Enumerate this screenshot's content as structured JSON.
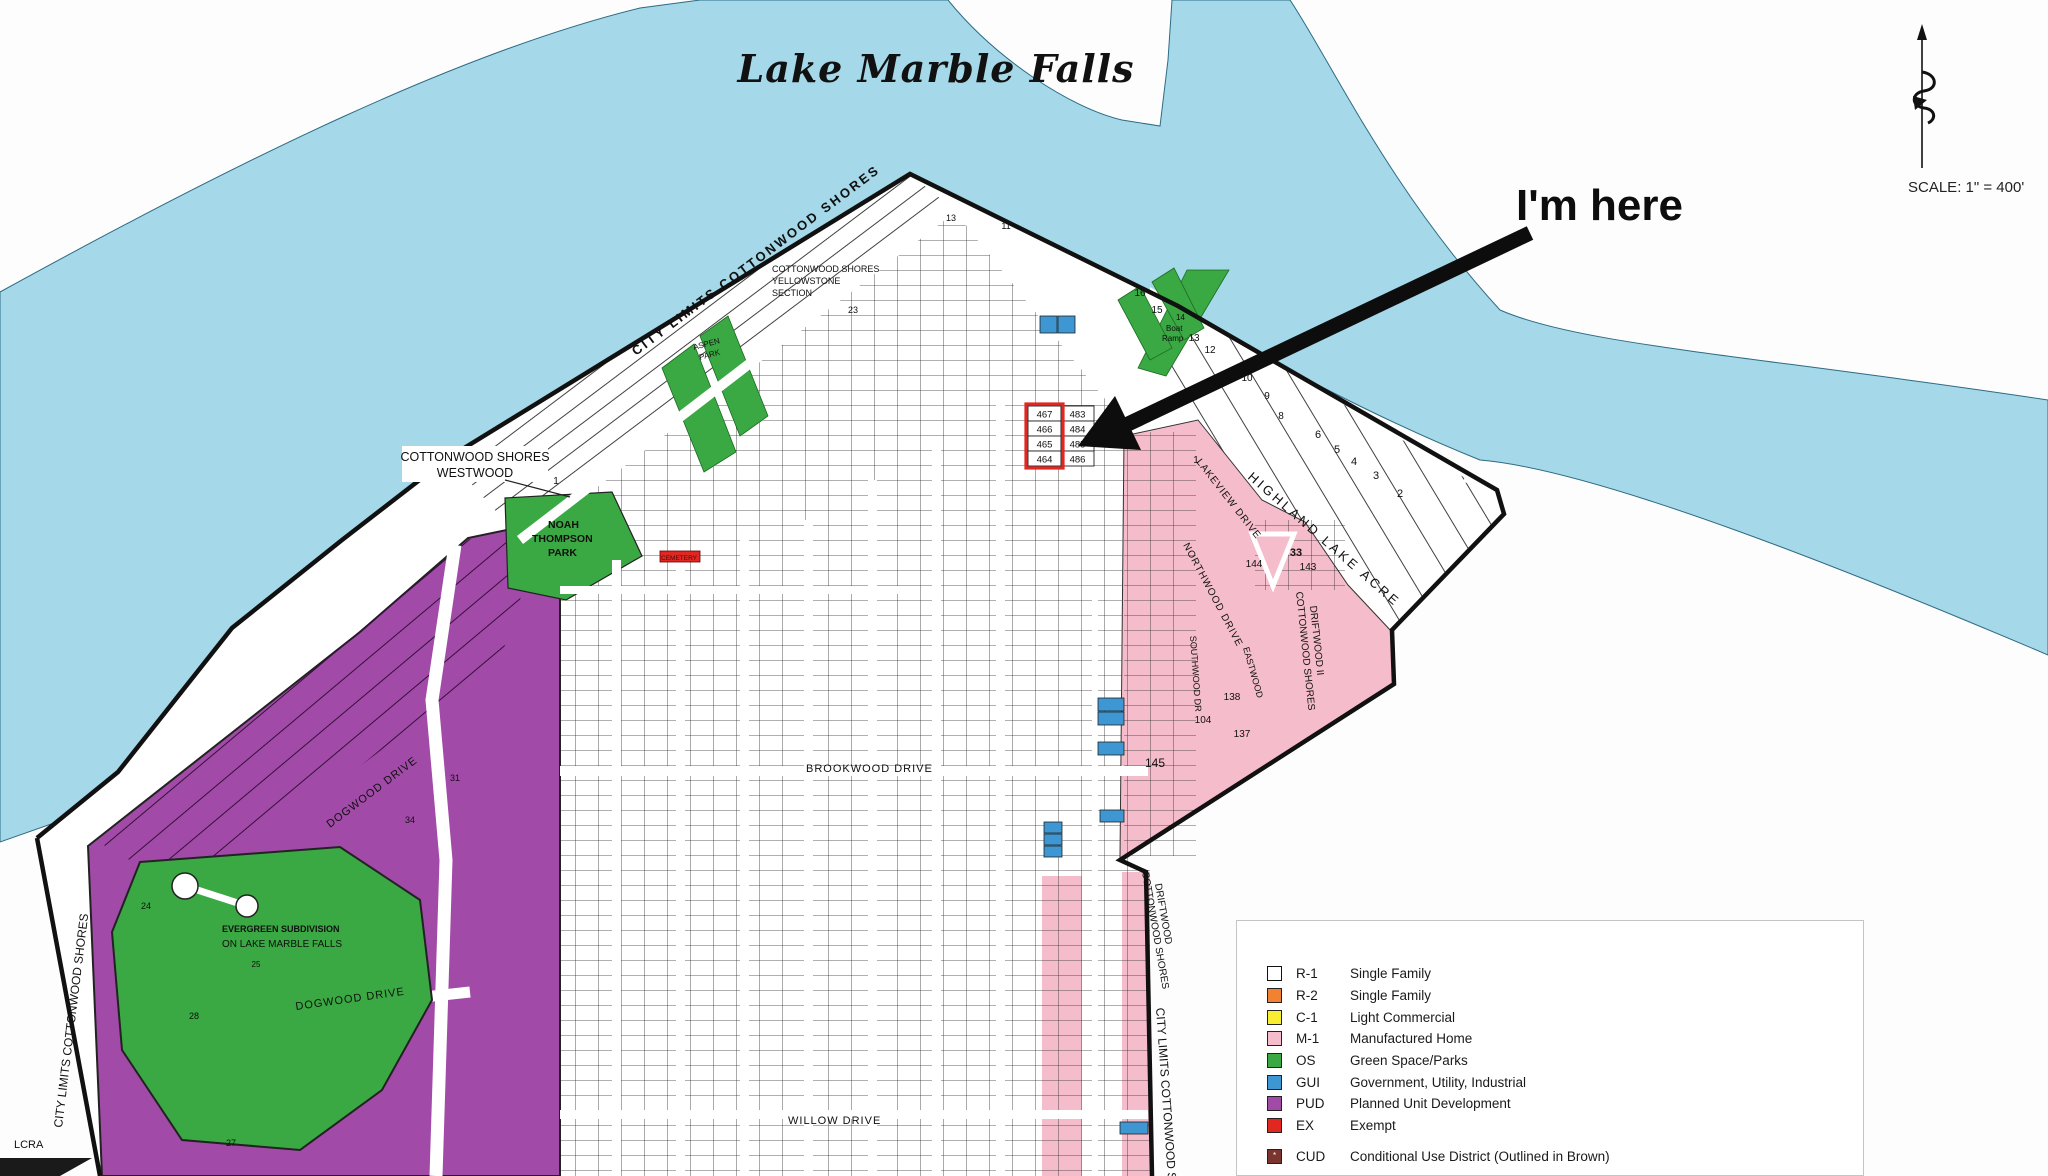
{
  "title": "Lake Marble Falls",
  "annotation": {
    "text": "I'm here"
  },
  "scale": {
    "text": "SCALE:  1\" = 400'"
  },
  "icons": {
    "north_arrow": "decorative-north-arrow",
    "target_marker": "red-outline-target"
  },
  "colors": {
    "water": "#a5d8e8",
    "land": "#ffffff",
    "boundary": "#111111",
    "r1": "#ffffff",
    "r2": "#f08232",
    "c1": "#f9ed32",
    "m1": "#f5bccb",
    "os": "#3aa843",
    "gui": "#3e96d2",
    "pud": "#a14aa7",
    "ex": "#e02721",
    "cud": "#7a352f"
  },
  "legend": {
    "items": [
      {
        "code": "R-1",
        "label": "Single Family",
        "color": "#ffffff"
      },
      {
        "code": "R-2",
        "label": "Single Family",
        "color": "#f08232"
      },
      {
        "code": "C-1",
        "label": "Light Commercial",
        "color": "#f9ed32"
      },
      {
        "code": "M-1",
        "label": "Manufactured Home",
        "color": "#f5bccb"
      },
      {
        "code": "OS",
        "label": "Green Space/Parks",
        "color": "#3aa843"
      },
      {
        "code": "GUI",
        "label": "Government, Utility, Industrial",
        "color": "#3e96d2"
      },
      {
        "code": "PUD",
        "label": "Planned Unit Development",
        "color": "#a14aa7"
      },
      {
        "code": "EX",
        "label": "Exempt",
        "color": "#e02721"
      }
    ],
    "cud": {
      "code": "CUD",
      "label": "Conditional Use District (Outlined in Brown)",
      "color": "#7a352f",
      "mark": "*"
    }
  },
  "map": {
    "labels": [
      {
        "t": "CITY  LIMITS  COTTONWOOD  SHORES",
        "x": 636,
        "y": 356,
        "r": -37,
        "s": 13,
        "ls": 2.5,
        "b": 1
      },
      {
        "t": "COTTONWOOD SHORES",
        "x": 772,
        "y": 272,
        "s": 9
      },
      {
        "t": "YELLOWSTONE",
        "x": 772,
        "y": 284,
        "s": 9
      },
      {
        "t": "SECTION",
        "x": 772,
        "y": 296,
        "s": 9
      },
      {
        "t": "ASPEN",
        "x": 694,
        "y": 350,
        "s": 8,
        "r": -15
      },
      {
        "t": "PARK",
        "x": 700,
        "y": 360,
        "s": 8,
        "r": -15
      },
      {
        "t": "NOAH",
        "x": 548,
        "y": 528,
        "s": 10.5,
        "b": 1
      },
      {
        "t": "THOMPSON",
        "x": 532,
        "y": 542,
        "s": 10.5,
        "b": 1
      },
      {
        "t": "PARK",
        "x": 548,
        "y": 556,
        "s": 10.5,
        "b": 1
      },
      {
        "t": "HIGHLAND LAKE ACRE",
        "x": 1247,
        "y": 478,
        "r": 41,
        "s": 13,
        "ls": 3
      },
      {
        "t": "COTTONWOOD SHORES",
        "x": 1296,
        "y": 592,
        "r": 84,
        "s": 10
      },
      {
        "t": "DRIFTWOOD II",
        "x": 1310,
        "y": 606,
        "r": 84,
        "s": 10
      },
      {
        "t": "COTTONWOOD SHORES",
        "x": 1142,
        "y": 872,
        "r": 80,
        "s": 10
      },
      {
        "t": "DRIFTWOOD",
        "x": 1155,
        "y": 884,
        "r": 80,
        "s": 10
      },
      {
        "t": "CITY LIMITS COTTONWOOD SHORES",
        "x": 1156,
        "y": 1008,
        "r": 86,
        "s": 12
      },
      {
        "t": "CITY LIMITS COTTONWOOD SHORES",
        "x": 62,
        "y": 1128,
        "r": -83,
        "s": 12
      },
      {
        "t": "DOGWOOD DRIVE",
        "x": 330,
        "y": 828,
        "r": -37,
        "s": 11,
        "ls": 1
      },
      {
        "t": "DOGWOOD DRIVE",
        "x": 296,
        "y": 1010,
        "r": -8,
        "s": 11,
        "ls": 1
      },
      {
        "t": "BROOKWOOD DRIVE",
        "x": 806,
        "y": 772,
        "s": 11,
        "ls": 1
      },
      {
        "t": "WILLOW DRIVE",
        "x": 788,
        "y": 1124,
        "s": 11,
        "ls": 1
      },
      {
        "t": "LAKEVIEW DRIVE",
        "x": 1196,
        "y": 462,
        "r": 52,
        "s": 10,
        "ls": 1
      },
      {
        "t": "NORTHWOOD DRIVE",
        "x": 1183,
        "y": 545,
        "r": 62,
        "s": 10,
        "ls": 1
      },
      {
        "t": "SOUTHWOOD DR",
        "x": 1190,
        "y": 636,
        "r": 86,
        "s": 9
      },
      {
        "t": "EASTWOOD",
        "x": 1243,
        "y": 648,
        "r": 74,
        "s": 9
      },
      {
        "t": "EVERGREEN SUBDIVISION",
        "x": 222,
        "y": 932,
        "s": 9,
        "b": 1
      },
      {
        "t": "ON LAKE MARBLE FALLS",
        "x": 222,
        "y": 947,
        "s": 10
      },
      {
        "t": "LCRA",
        "x": 14,
        "y": 1148,
        "s": 11
      },
      {
        "t": "14",
        "x": 1176,
        "y": 320,
        "s": 8
      },
      {
        "t": "Boat",
        "x": 1166,
        "y": 331,
        "s": 8
      },
      {
        "t": "Ramp",
        "x": 1162,
        "y": 341,
        "s": 8
      },
      {
        "t": "CEMETERY",
        "x": 661,
        "y": 560,
        "s": 6.5,
        "c": "#4a0c08"
      },
      {
        "t": "COTTONWOOD SHORES",
        "x": 475,
        "y": 461,
        "s": 12.5,
        "a": "middle"
      },
      {
        "t": "WESTWOOD",
        "x": 475,
        "y": 477,
        "s": 12.5,
        "a": "middle"
      }
    ],
    "parcel_labels": [
      {
        "t": "145",
        "x": 1155,
        "y": 767,
        "s": 12
      },
      {
        "t": "104",
        "x": 1203,
        "y": 723,
        "s": 10
      },
      {
        "t": "137",
        "x": 1242,
        "y": 737,
        "s": 10
      },
      {
        "t": "138",
        "x": 1232,
        "y": 700,
        "s": 10
      },
      {
        "t": "144",
        "x": 1254,
        "y": 567,
        "s": 10
      },
      {
        "t": "143",
        "x": 1308,
        "y": 570,
        "s": 10
      },
      {
        "t": "33",
        "x": 1296,
        "y": 556,
        "s": 11,
        "b": 1
      },
      {
        "t": "1",
        "x": 1196,
        "y": 463,
        "s": 10
      },
      {
        "t": "1",
        "x": 556,
        "y": 484,
        "s": 10
      },
      {
        "t": "2",
        "x": 1400,
        "y": 497,
        "s": 11
      },
      {
        "t": "3",
        "x": 1376,
        "y": 479,
        "s": 11
      },
      {
        "t": "4",
        "x": 1354,
        "y": 465,
        "s": 11
      },
      {
        "t": "5",
        "x": 1337,
        "y": 453,
        "s": 11
      },
      {
        "t": "6",
        "x": 1318,
        "y": 438,
        "s": 11
      },
      {
        "t": "8",
        "x": 1281,
        "y": 419,
        "s": 10
      },
      {
        "t": "9",
        "x": 1267,
        "y": 399,
        "s": 10
      },
      {
        "t": "10",
        "x": 1247,
        "y": 381,
        "s": 10
      },
      {
        "t": "12",
        "x": 1210,
        "y": 353,
        "s": 10
      },
      {
        "t": "13",
        "x": 1194,
        "y": 341,
        "s": 10
      },
      {
        "t": "15",
        "x": 1157,
        "y": 313,
        "s": 10
      },
      {
        "t": "16",
        "x": 1140,
        "y": 296,
        "s": 10
      },
      {
        "t": "13",
        "x": 951,
        "y": 221,
        "s": 9
      },
      {
        "t": "11",
        "x": 1006,
        "y": 229,
        "s": 9
      },
      {
        "t": "23",
        "x": 853,
        "y": 313,
        "s": 9
      },
      {
        "t": "24",
        "x": 146,
        "y": 909,
        "s": 9
      },
      {
        "t": "25",
        "x": 256,
        "y": 967,
        "s": 8
      },
      {
        "t": "28",
        "x": 194,
        "y": 1019,
        "s": 9
      },
      {
        "t": "27",
        "x": 231,
        "y": 1146,
        "s": 9
      },
      {
        "t": "31",
        "x": 455,
        "y": 781,
        "s": 9
      },
      {
        "t": "34",
        "x": 410,
        "y": 823,
        "s": 9
      }
    ],
    "target": {
      "numbers": [
        "467",
        "466",
        "465",
        "464"
      ],
      "adjacent": [
        "483",
        "484",
        "485",
        "486"
      ]
    }
  }
}
